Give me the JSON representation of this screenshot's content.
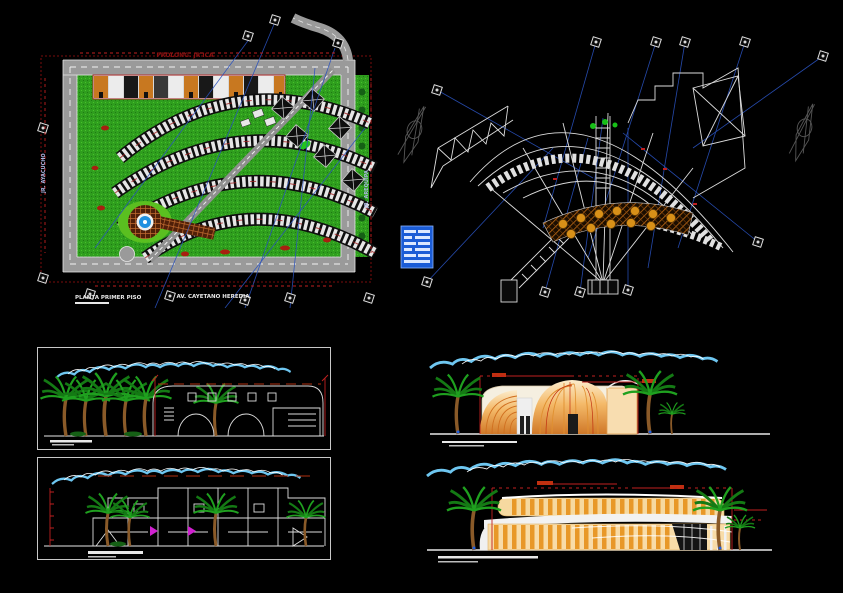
{
  "colors": {
    "background": "#000000",
    "grass_green": "#2f9e1e",
    "grass_dark": "#1e7a12",
    "road_gray": "#9a9a9a",
    "line_white": "#e8e8e8",
    "accent_red": "#c02020",
    "dark_red": "#8a1010",
    "leader_blue": "#2a52be",
    "cloud_blue": "#6ec6f0",
    "building_orange": "#e89828",
    "building_cream": "#f8dca8",
    "palm_green": "#1fa01f",
    "trunk_brown": "#8a5a28",
    "pool_blue": "#2090e0",
    "terrace_brown": "#8a4a10",
    "table_yellow": "#d89018",
    "magenta": "#d020d0",
    "legend_blue": "#1b5cd6"
  },
  "site_plan": {
    "title_top": "PROLONG. JR ICA",
    "street_left": "JR. AYACUCHO",
    "street_right": "JR. AREQUIPA",
    "plan_label": "PLANTA PRIMER PISO",
    "avenue_label": "AV. CAYETANO HEREDIA"
  },
  "icons": {
    "north_arrow": "stylized compass arrow (gray line art)",
    "grid_bubble": "rotated square axis marker with center dot",
    "legend_table": "small blue schedule table block"
  }
}
